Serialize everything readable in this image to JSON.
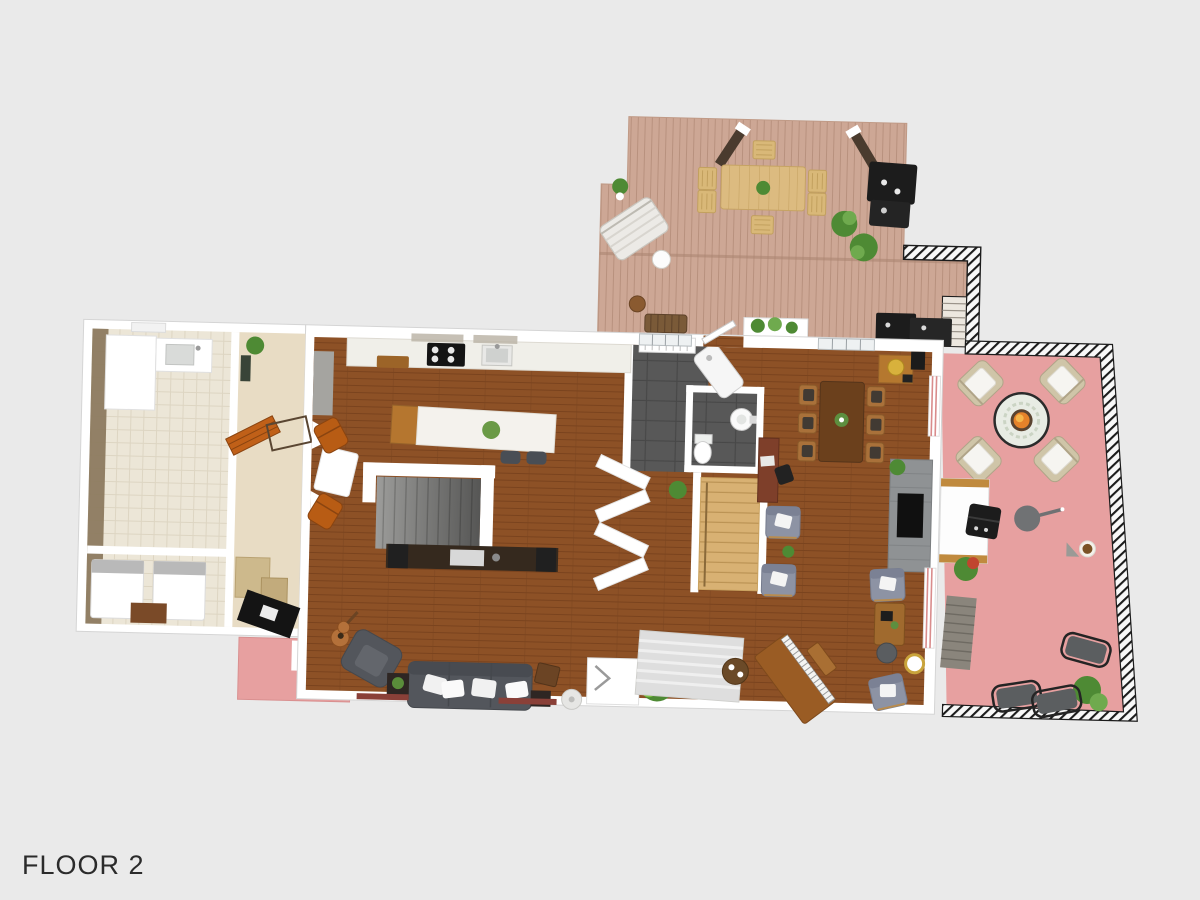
{
  "floor_label": "FLOOR 2",
  "colors": {
    "background": "#eaeaea",
    "label": "#2b2b2b",
    "wall": "#ffffff",
    "wall_shadow": "#d2d2d2",
    "deck": "#cda795",
    "deck_line": "#b8917e",
    "patio": "#e7a0a0",
    "railing_dark": "#1c1c1c",
    "wood": "#8d5126",
    "wood_line": "#7a431e",
    "tile": "#585858",
    "tile_line": "#484848",
    "cream": "#ece6d7",
    "cream_line": "#ddd5c2",
    "hall": "#e8dcc4",
    "stair_wood": "#d8b173",
    "stair_wood_line": "#bb9354",
    "stair_gray": "#9c9c9a",
    "sofa_gray": "#53565c",
    "chair_gray": "#8d93a4",
    "leather_orange": "#b85c14",
    "island_wood": "#b5762f",
    "counter_white": "#f0efe9",
    "fire_orange": "#e5822a",
    "plant_green": "#4e8a34",
    "plant_light": "#7cc244",
    "table_wood": "#6b401c",
    "frame_wood": "#a9713a",
    "stone_gray": "#8f9294",
    "black_appliance": "#1c1c1c",
    "wicker_tan": "#cfc5a8",
    "cushion_white": "#f6f5f1"
  },
  "plan": {
    "areas": [
      "deck",
      "patio",
      "garage",
      "hallway",
      "kitchen",
      "living-room",
      "dining-room",
      "entry",
      "bathroom",
      "stairs",
      "porch"
    ],
    "deck_furniture": [
      "outdoor-dining-table",
      "outdoor-chairs",
      "sun-lounger",
      "grill",
      "potted-plants",
      "wicker-bench",
      "planter-box",
      "pergola-posts",
      "outdoor-kitchen"
    ],
    "patio_furniture": [
      "fire-pit-table",
      "wicker-armchairs",
      "outdoor-table",
      "grill",
      "umbrella",
      "lounge-chairs",
      "stone-steps",
      "potted-plants"
    ],
    "interior_furniture": [
      "kitchen-island",
      "bar-stools",
      "cooktop",
      "kitchen-sink",
      "sofa",
      "armchair",
      "guitar",
      "media-console",
      "floor-lamp",
      "dining-table",
      "dining-chairs",
      "bar-cart",
      "fireplace",
      "desk",
      "piano",
      "piano-bench",
      "area-rug",
      "coffee-table",
      "reading-chairs",
      "washer-dryer",
      "utility-sink",
      "storage-boxes",
      "toilet",
      "bathroom-sink",
      "shower"
    ]
  }
}
